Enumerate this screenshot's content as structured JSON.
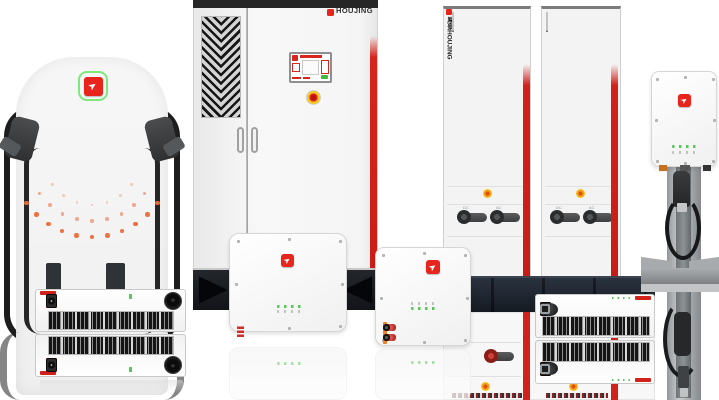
{
  "brand": {
    "name": "HOUJING",
    "vertical_name": "厚景HOUJING",
    "logo_glyph": "➤"
  },
  "colors": {
    "accent_red": "#d0211b",
    "logo_red": "#e8251d",
    "logo_green_ring": "#7de87c",
    "led_green": "#58c858",
    "dot_orange": "#ec6a38",
    "estop_yellow": "#f5c91e",
    "base_dark": "#151a22"
  },
  "pillar": {
    "dot_arcs": [
      {
        "radius": 80,
        "count": 11,
        "size": 4.5,
        "opacity": 0.95
      },
      {
        "radius": 64,
        "count": 9,
        "size": 3.5,
        "opacity": 0.55
      },
      {
        "radius": 48,
        "count": 7,
        "size": 2.5,
        "opacity": 0.3
      }
    ]
  },
  "rack": {
    "module_count": 8,
    "switch_labels": [
      "DC",
      "AC"
    ]
  },
  "modules": {
    "left": {
      "connectors": [
        "orange",
        "orange",
        "orange",
        "orange",
        "gap",
        "orange",
        "black"
      ]
    },
    "right": {
      "connectors": [
        "orange",
        "black",
        "orange",
        "black",
        "gap",
        "knob",
        "gap",
        "circle-maroon",
        "circle-dark",
        "circle-dark",
        "square-silver"
      ]
    }
  },
  "boxes": {
    "box1": {
      "terminals": [
        "orange-bar",
        "black-term",
        "black-term",
        "black-term",
        "red-striped",
        "red-striped",
        "black-term",
        "black-term",
        "black-term",
        "red-striped",
        "red-striped"
      ]
    },
    "box2": {
      "terminals": [
        "orange-bar",
        "red-round",
        "circle-dark2",
        "circle-dark2",
        "circle-dark2"
      ]
    }
  }
}
